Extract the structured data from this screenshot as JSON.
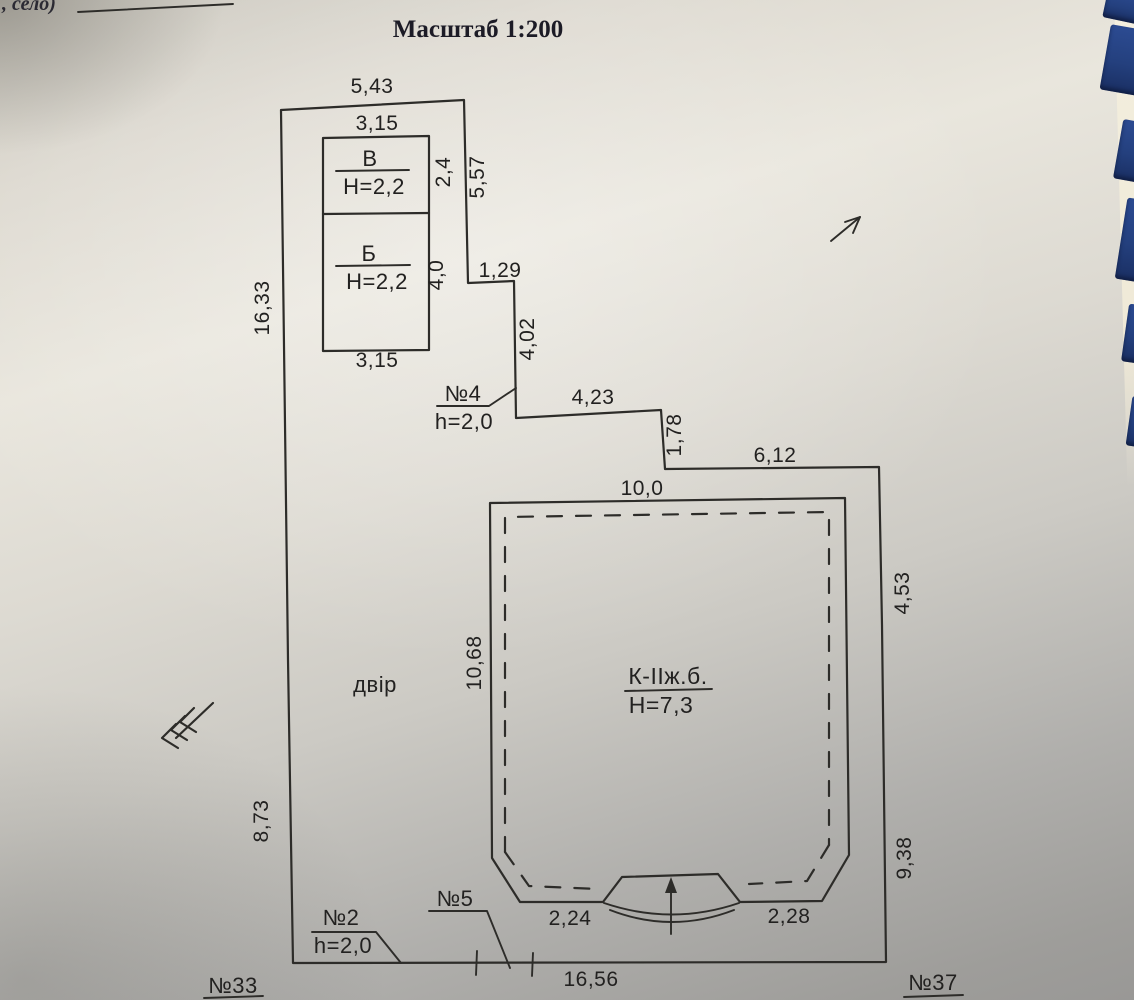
{
  "page": {
    "corner_note": ", село)",
    "title": "Масштаб 1:200"
  },
  "site": {
    "yard_label": "двір",
    "neighbor_left": "№33",
    "neighbor_right": "№37",
    "boundary_dims": {
      "top": "5,43",
      "left_upper": "16,33",
      "left_lower": "8,73",
      "right_upper_vert": "5,57",
      "step_horiz_1": "1,29",
      "step_vert_1": "4,02",
      "step_horiz_2": "4,23",
      "step_vert_2": "1,78",
      "step_horiz_3": "6,12",
      "right_mid": "4,53",
      "right_lower": "9,38",
      "bottom": "16,56"
    },
    "outbuilding": {
      "width_top": "3,15",
      "width_bottom": "3,15",
      "section_v": {
        "name": "В",
        "height": "H=2,2",
        "depth": "2,4"
      },
      "section_b": {
        "name": "Б",
        "height": "H=2,2",
        "depth": "4,0"
      }
    },
    "main_house": {
      "label": "К-ІІж.б.",
      "height": "H=7,3",
      "width_top": "10,0",
      "depth_left": "10,68",
      "porch_left": "2,24",
      "porch_right": "2,28"
    },
    "gates": {
      "gate_4": {
        "label": "№4",
        "height": "h=2,0"
      },
      "gate_2": {
        "label": "№2",
        "height": "h=2,0"
      },
      "gate_5": {
        "label": "№5"
      }
    }
  }
}
